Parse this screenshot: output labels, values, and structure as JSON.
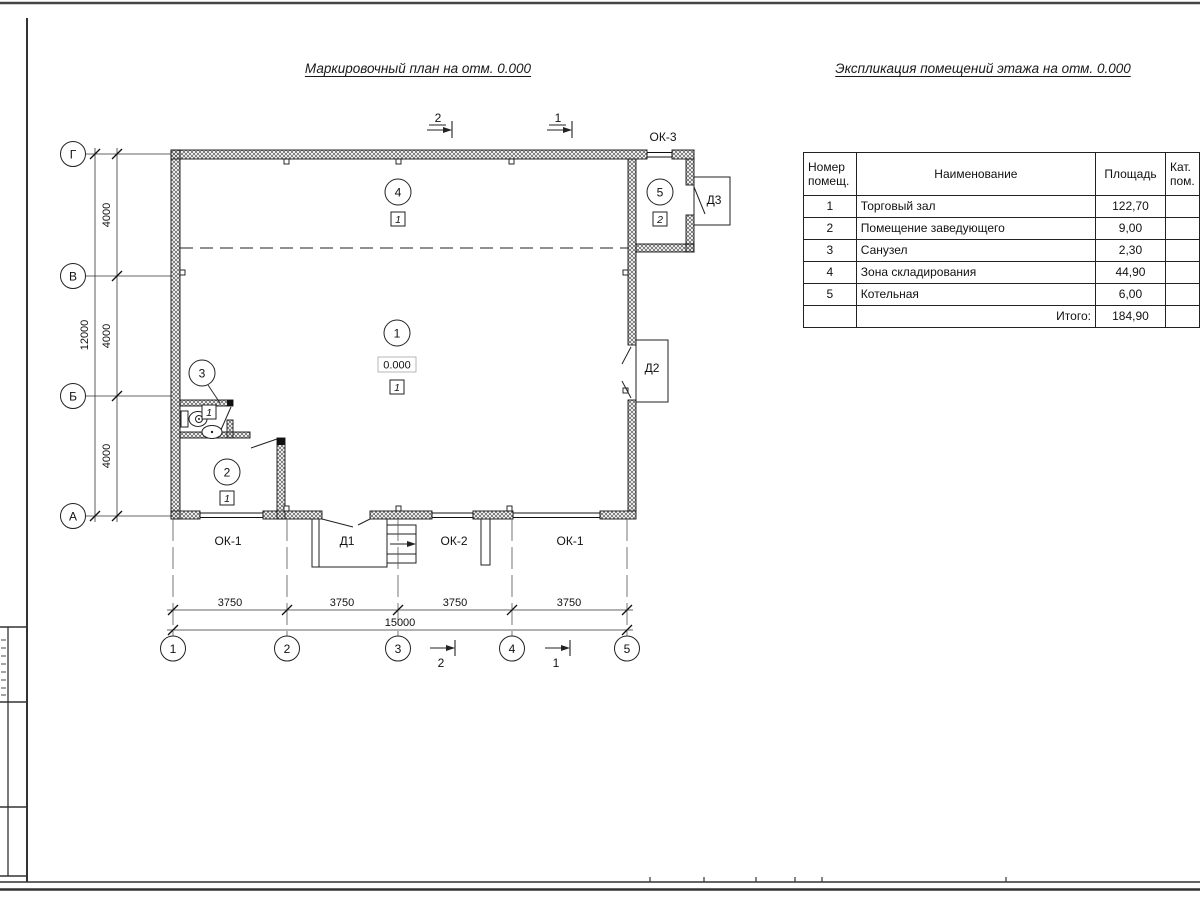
{
  "titles": {
    "plan": "Маркировочный план на отм. 0.000",
    "explication": "Экспликация помещений этажа на отм. 0.000"
  },
  "explication_table": {
    "headers": {
      "num": "Номер помещ.",
      "name": "Наименование",
      "area": "Площадь",
      "cat": "Кат. пом."
    },
    "rows": [
      {
        "num": "1",
        "name": "Торговый зал",
        "area": "122,70",
        "cat": ""
      },
      {
        "num": "2",
        "name": "Помещение заведующего",
        "area": "9,00",
        "cat": ""
      },
      {
        "num": "3",
        "name": "Санузел",
        "area": "2,30",
        "cat": ""
      },
      {
        "num": "4",
        "name": "Зона складирования",
        "area": "44,90",
        "cat": ""
      },
      {
        "num": "5",
        "name": "Котельная",
        "area": "6,00",
        "cat": ""
      }
    ],
    "total": {
      "label": "Итого:",
      "value": "184,90"
    }
  },
  "plan": {
    "row_axes": [
      "Г",
      "В",
      "Б",
      "А"
    ],
    "col_axes": [
      "1",
      "2",
      "3",
      "4",
      "5"
    ],
    "dims": {
      "v_segments": [
        "4000",
        "4000",
        "4000"
      ],
      "v_total": "12000",
      "h_segments": [
        "3750",
        "3750",
        "3750",
        "3750"
      ],
      "h_total": "15000"
    },
    "level_mark": "0.000",
    "rooms": {
      "r1": {
        "num": "1",
        "floor": "1"
      },
      "r2": {
        "num": "2",
        "floor": "1"
      },
      "r3": {
        "num": "3",
        "floor": "1"
      },
      "r4": {
        "num": "4",
        "floor": "1"
      },
      "r5": {
        "num": "5",
        "floor": "2"
      }
    },
    "labels": {
      "ok1": "ОК-1",
      "ok2": "ОК-2",
      "ok3": "ОК-3",
      "d1": "Д1",
      "d2": "Д2",
      "d3": "Д3"
    },
    "sections": {
      "s1": "1",
      "s2": "2"
    }
  }
}
